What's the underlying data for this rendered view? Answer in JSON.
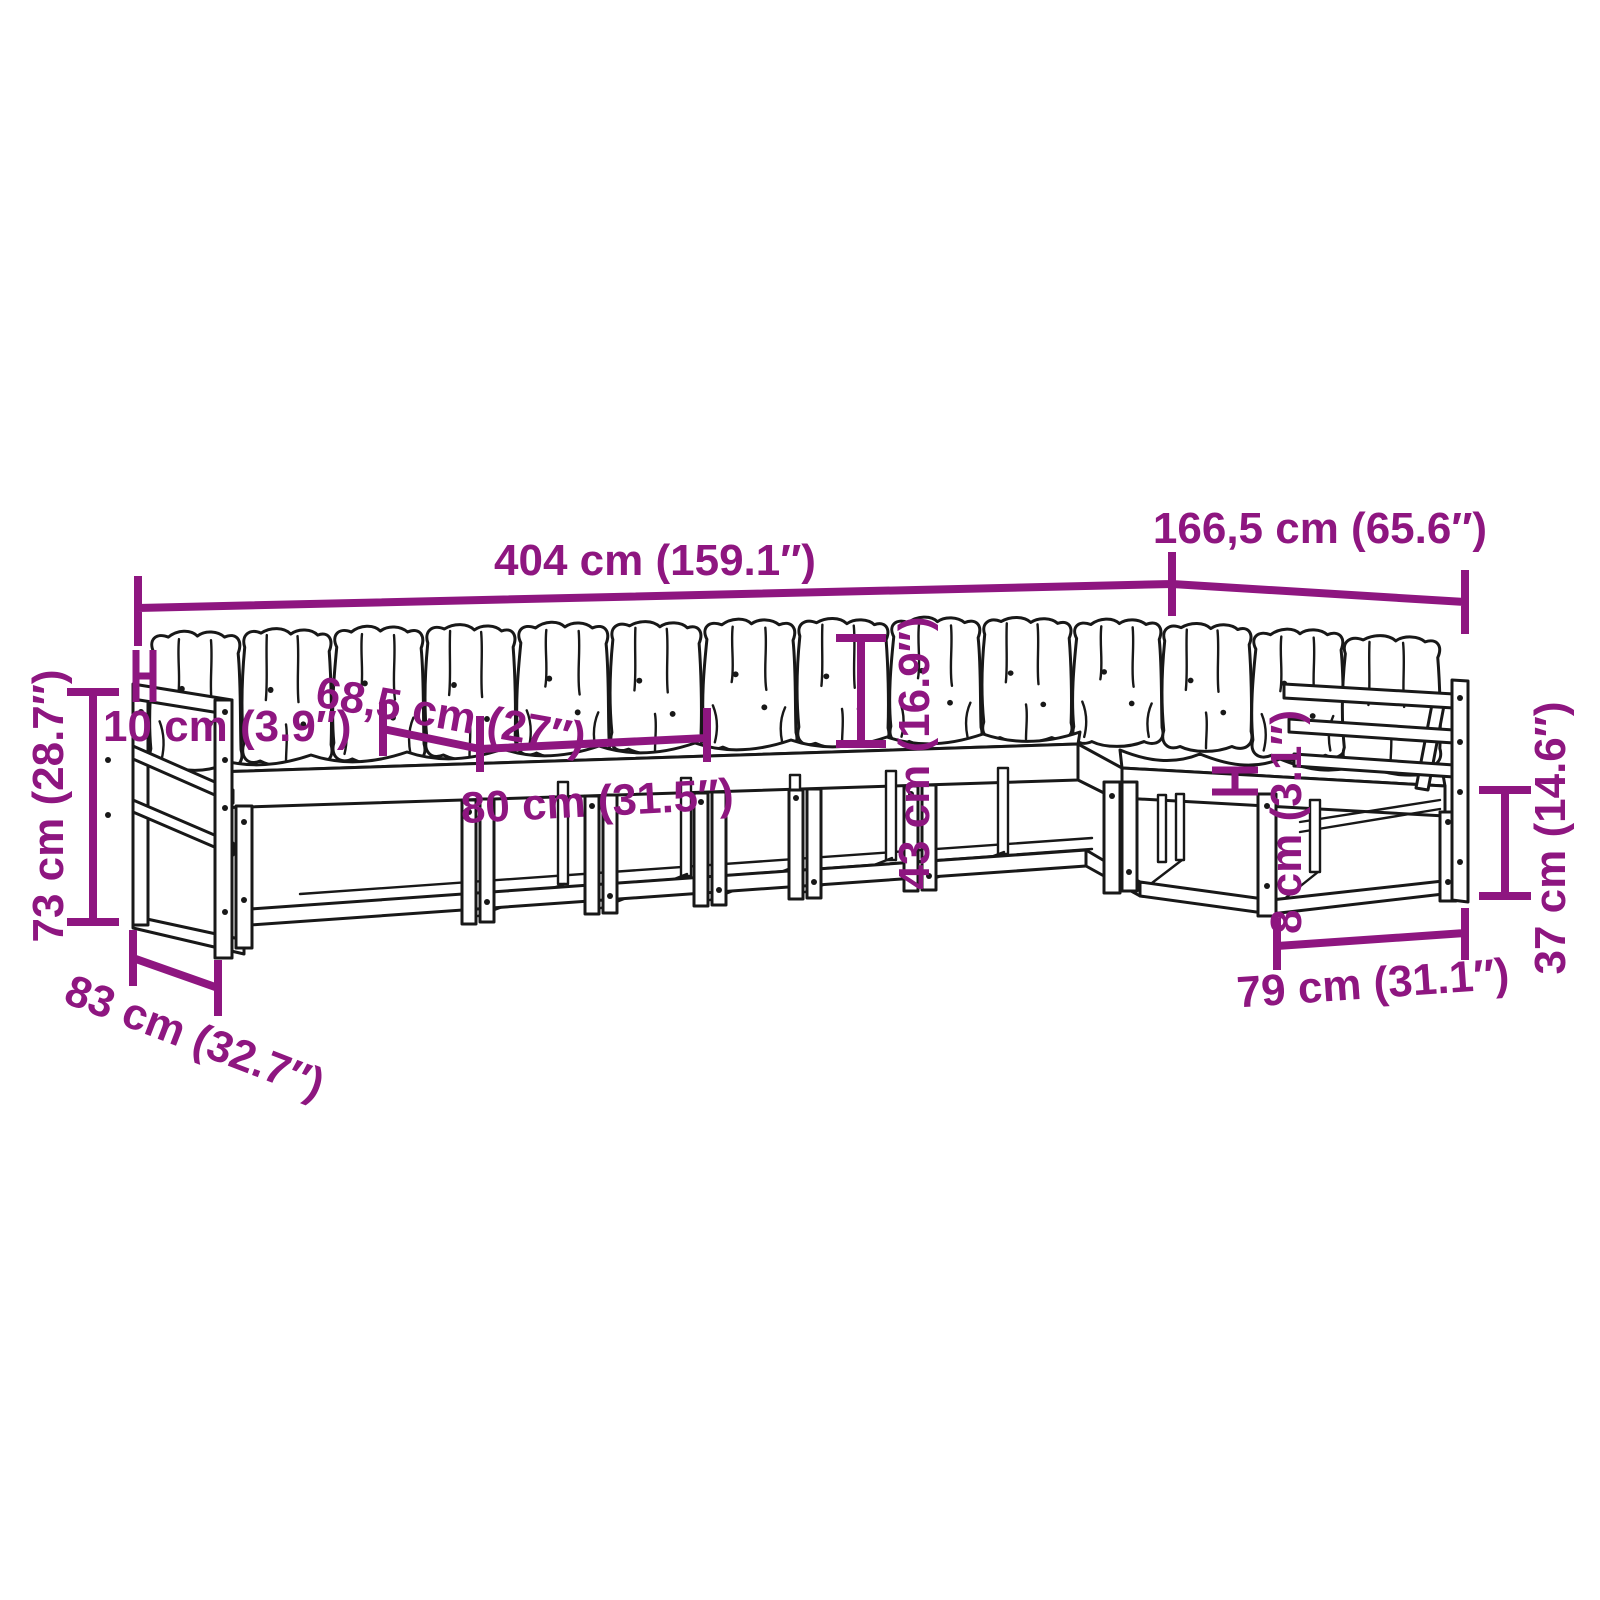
{
  "diagram_type": "furniture-dimension-diagram",
  "product": "modular garden corner sofa set with cushions",
  "colors": {
    "dimension_accent": "#8E1680",
    "line_art": "#181818",
    "background": "#ffffff"
  },
  "labels": {
    "total_width": "404 cm (159.1″)",
    "right_side_depth": "166,5 cm (65.6″)",
    "seat_depth": "68,5 cm (27″)",
    "backrest_rail_width": "10 cm (3.9″)",
    "total_height": "73 cm (28.7″)",
    "left_module_depth": "83 cm (32.7″)",
    "module_width": "80 cm (31.5″)",
    "backrest_height": "43 cm (16.9″)",
    "seat_plank_thickness": "8 cm (3.1″)",
    "seat_height": "37 cm (14.6″)",
    "right_module_width": "79 cm (31.1″)"
  }
}
